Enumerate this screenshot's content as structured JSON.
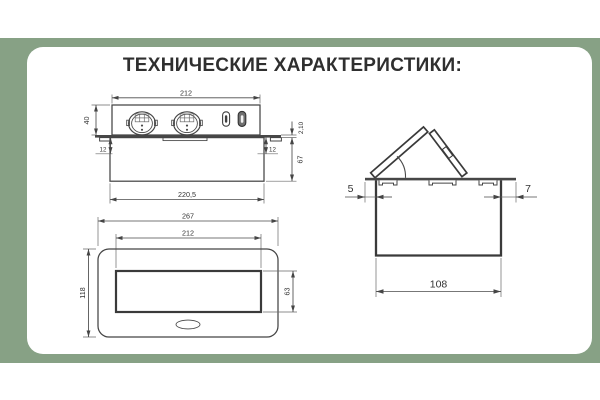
{
  "title": "ТЕХНИЧЕСКИЕ ХАРАКТЕРИСТИКИ:",
  "colors": {
    "background_green": "#87a185",
    "card": "#ffffff",
    "drawing_line": "#454545",
    "dimension_text": "#333333",
    "title_text": "#2f2f2f",
    "flange_fill": "#474747",
    "usb_c_fill": "#707070"
  },
  "front_view": {
    "dim_top_width": "212",
    "dim_height": "40",
    "dim_left_inset": "12",
    "dim_right_inset": "12",
    "dim_flange_thickness": "2,10",
    "dim_body_depth": "67",
    "dim_bottom_width": "220,5"
  },
  "top_view": {
    "dim_outer_width": "267",
    "dim_inner_width": "212",
    "dim_outer_depth": "118",
    "dim_inner_depth": "63"
  },
  "side_view": {
    "dim_left_overhang": "5",
    "dim_right_overhang": "7",
    "dim_body_width": "108"
  }
}
